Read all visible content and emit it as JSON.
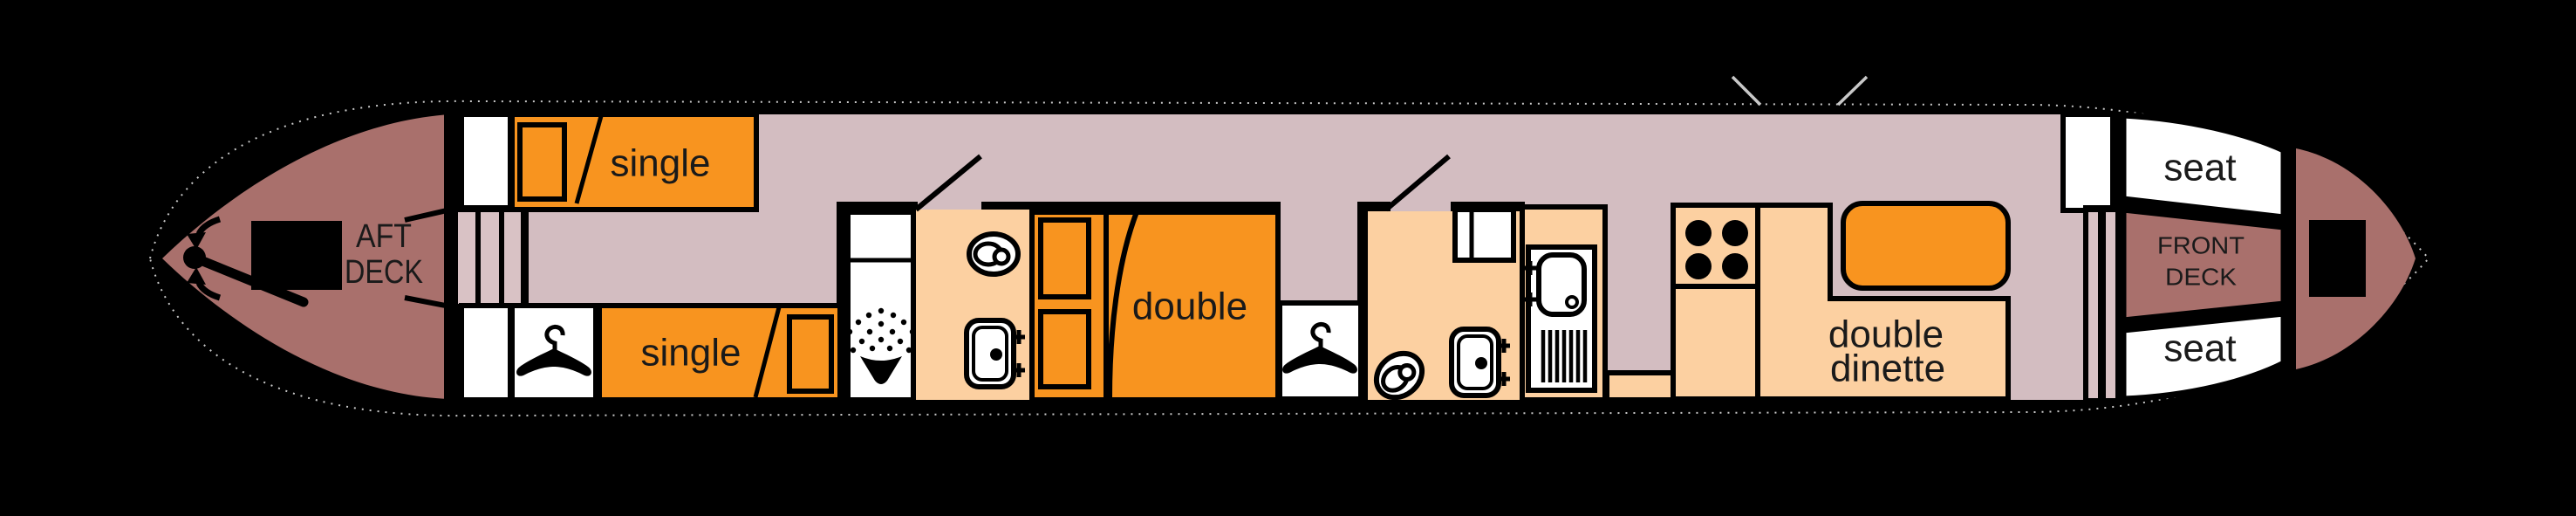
{
  "aft_deck": {
    "line1": "AFT",
    "line2": "DECK"
  },
  "front_deck": {
    "line1": "FRONT",
    "line2": "DECK"
  },
  "cabin": {
    "single_bed_top": {
      "label": "single"
    },
    "single_bed_bottom": {
      "label": "single"
    },
    "double_bed": {
      "label": "double"
    },
    "dinette": {
      "line1": "double",
      "line2": "dinette"
    }
  },
  "bow": {
    "seat_top": {
      "label": "seat"
    },
    "seat_bottom": {
      "label": "seat"
    }
  },
  "icons": {
    "tiller": "pivot-dot-with-rod",
    "tiller_swing_arrows": "curved-arrows",
    "engine_hatch": "black-rectangle",
    "coat_hanger": "hanger-glyph",
    "shower": "spray-fan-over-funnel",
    "toilet": "oval-rings",
    "basin": "rounded-rect-with-taps",
    "kitchen_sink": "bowl-with-drainer-bars",
    "hob": "four-burner-circles",
    "side_hatch": "v-tick-marks",
    "steps": "parallel-bars"
  },
  "colors": {
    "background": "#000000",
    "deck": "#a9706c",
    "floor": "#d3bdc1",
    "steps": "#d9c2c5",
    "furniture": "#fcd0a1",
    "highlight": "#f8941f",
    "fixture": "#ffffff",
    "line": "#000000",
    "hull_outline": "#c8c8c8",
    "text": "#1a1a1a"
  }
}
